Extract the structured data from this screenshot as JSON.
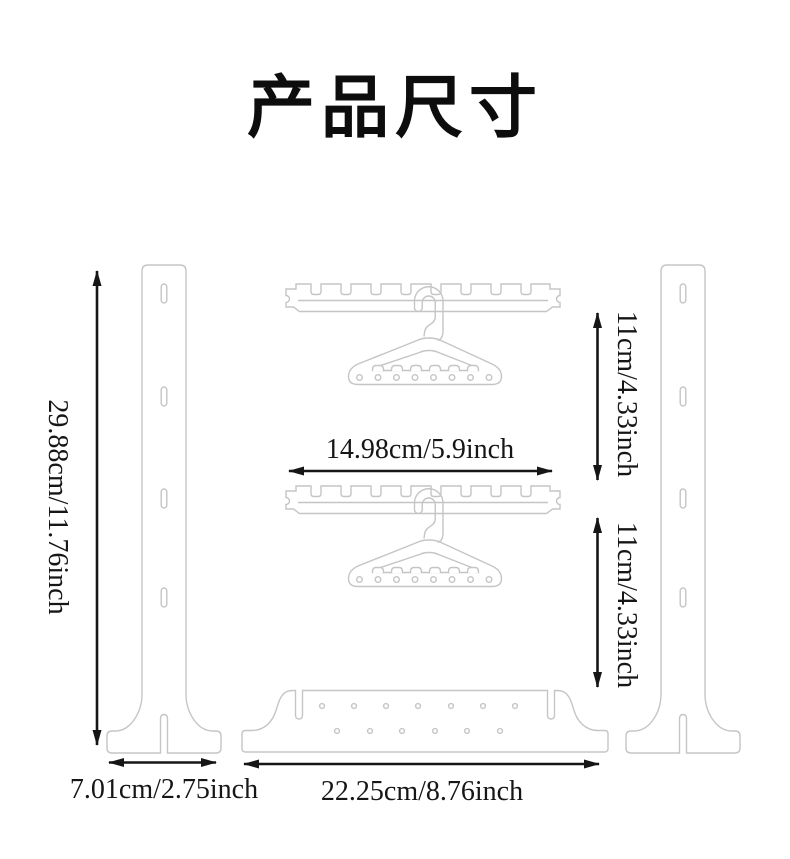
{
  "title": {
    "text": "产品尺寸"
  },
  "colors": {
    "outline": "#c5c5c5",
    "dimension": "#161616",
    "background": "#ffffff"
  },
  "dimensions": {
    "post_height": "29.88cm/11.76inch",
    "hanger_bar_length": "14.98cm/5.9inch",
    "upper_gap": "11cm/4.33inch",
    "lower_gap": "11cm/4.33inch",
    "foot_width": "7.01cm/2.75inch",
    "base_length": "22.25cm/8.76inch"
  },
  "parts": {
    "left_post": "side-post-outline",
    "right_post": "side-post-outline",
    "hanger_bars": "notched-hanger-bar-outline",
    "hangers": "clothes-hanger-outline",
    "base_plate": "base-plate-outline"
  }
}
